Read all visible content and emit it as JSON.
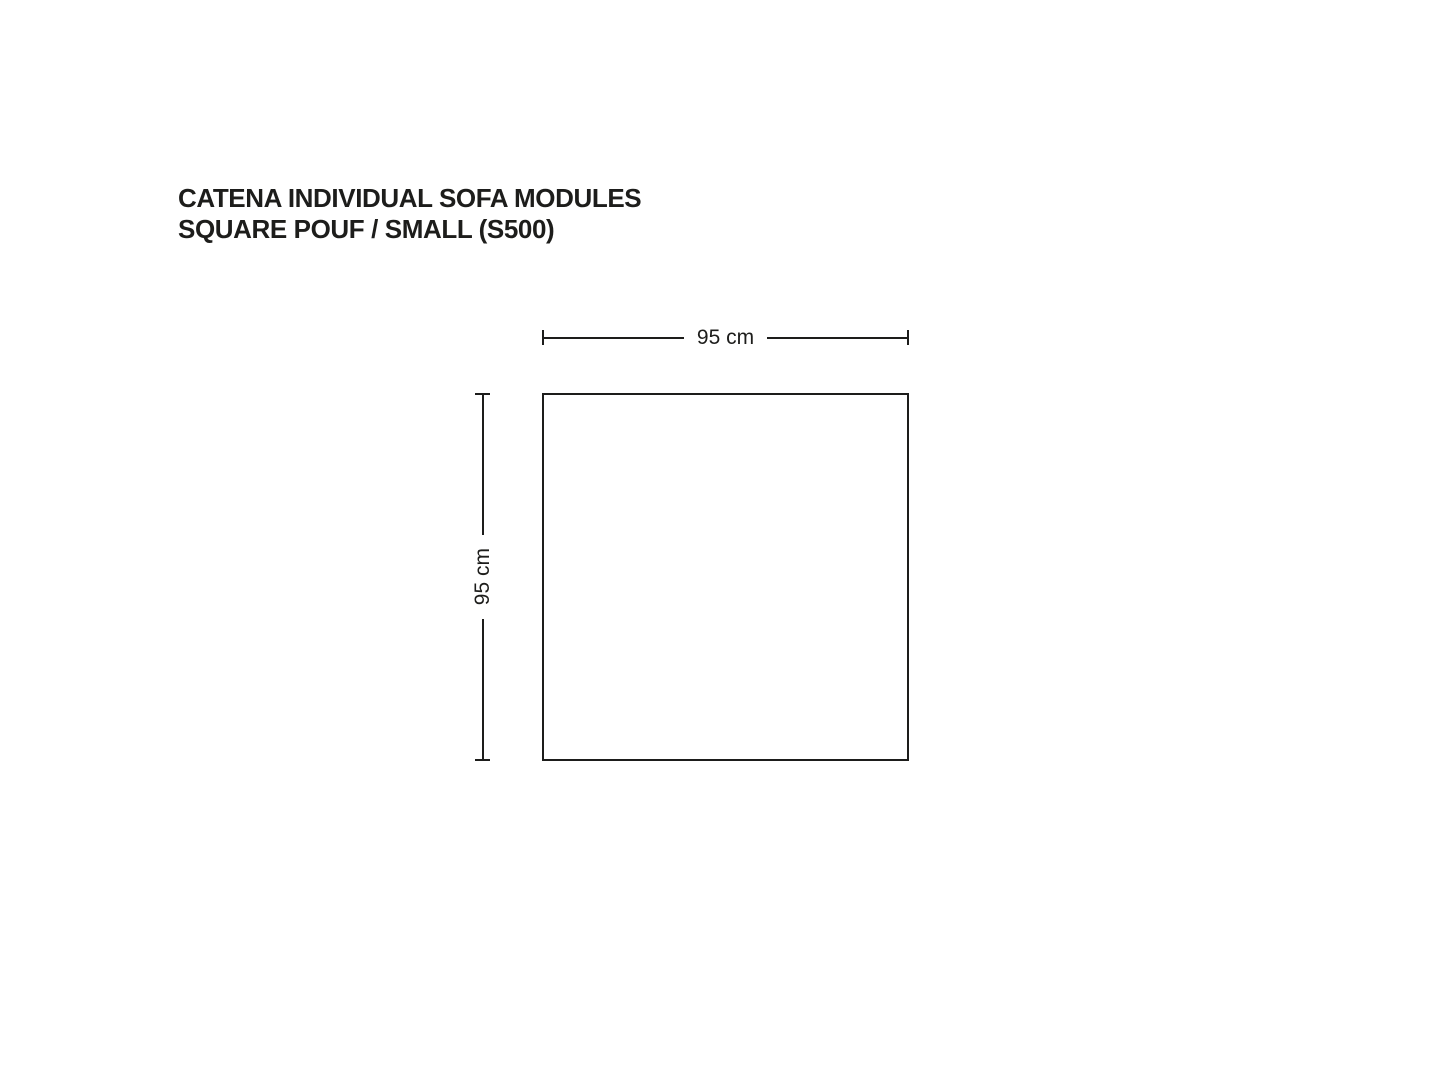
{
  "title": {
    "line1": "CATENA INDIVIDUAL SOFA MODULES",
    "line2": "SQUARE POUF / SMALL (S500)"
  },
  "diagram": {
    "width_label": "95 cm",
    "height_label": "95 cm"
  },
  "colors": {
    "ink": "#1d1d1b",
    "background": "#ffffff"
  }
}
